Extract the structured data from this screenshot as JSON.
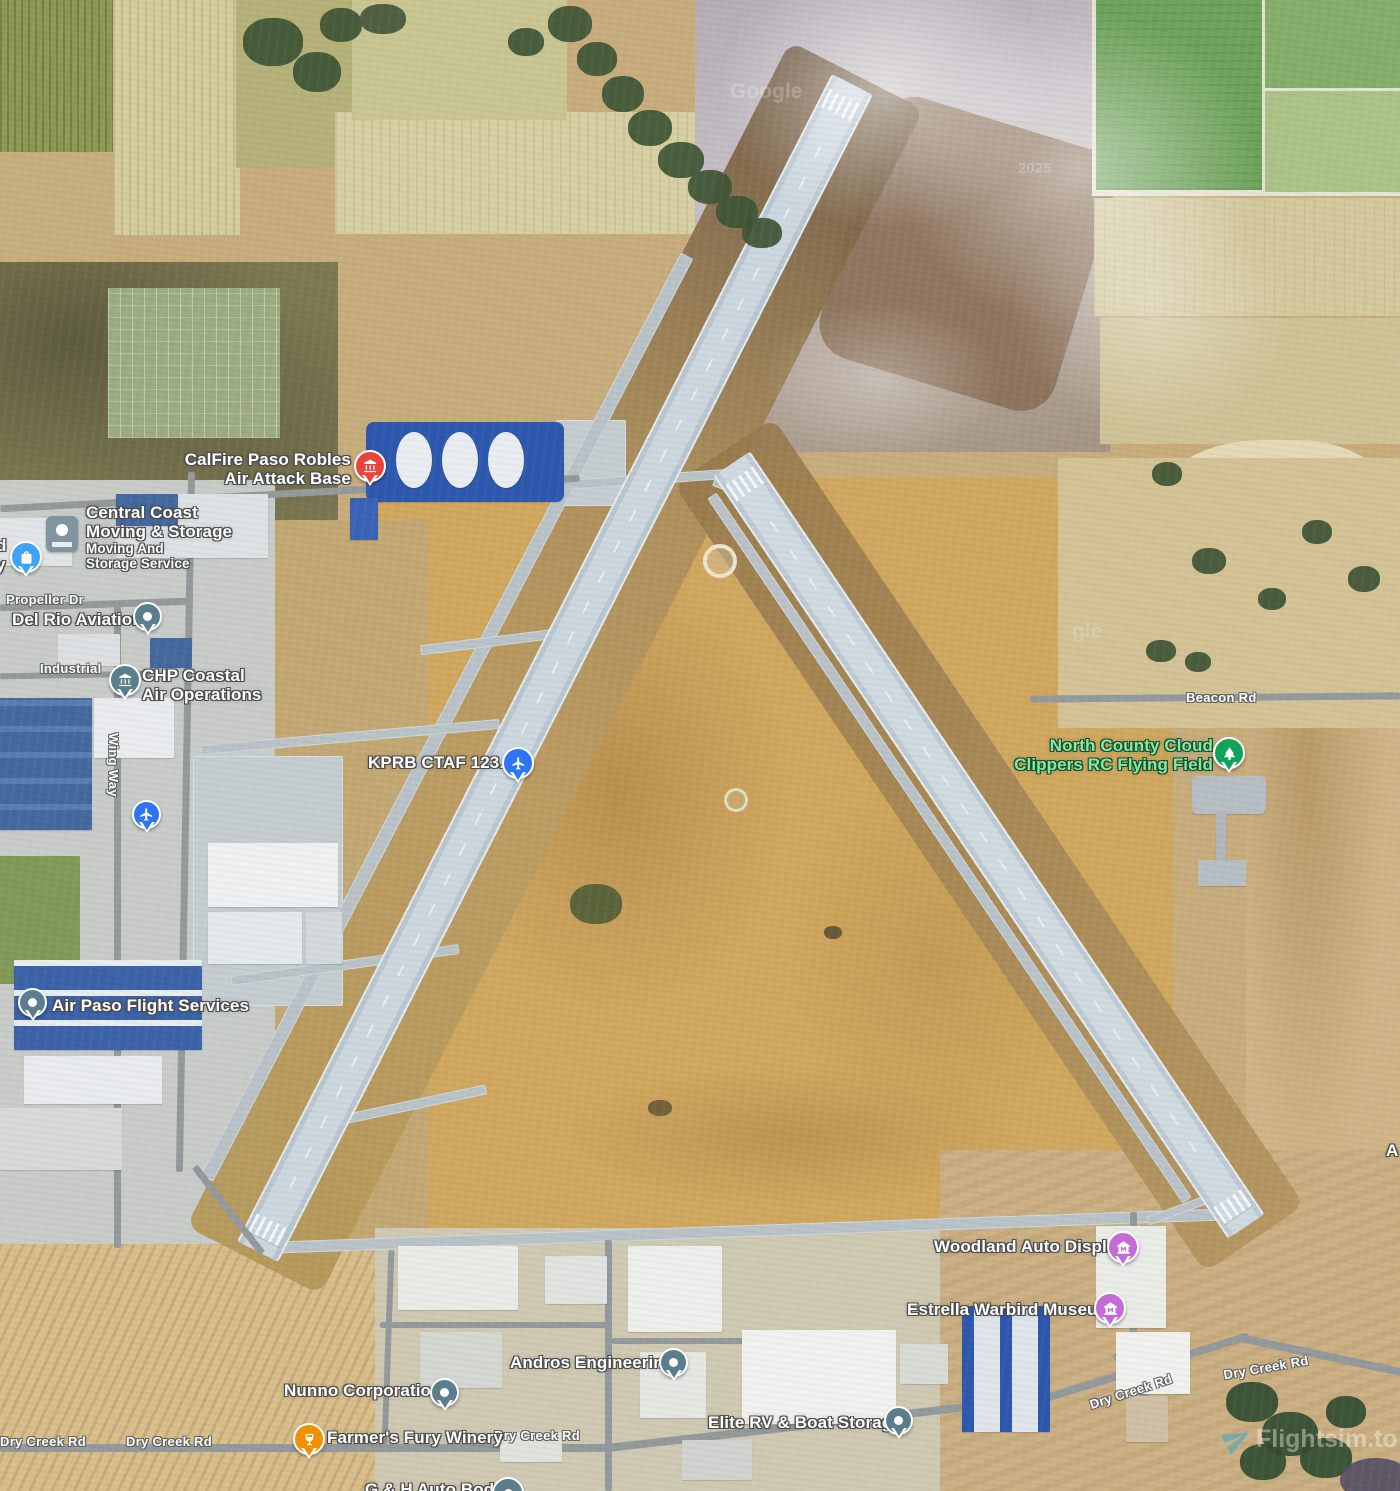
{
  "map": {
    "kind": "satellite",
    "pois": {
      "calfire": {
        "line1": "CalFire Paso Robles",
        "line2": "Air Attack Base",
        "icon": "government-building-icon",
        "pin_color": "#e8443a"
      },
      "central_coast": {
        "line1": "Central Coast",
        "line2": "Moving & Storage",
        "sub1": "Moving And",
        "sub2": "Storage Service",
        "icon": "shopping-bag-icon",
        "pin_color": "#3fa2f7"
      },
      "del_rio": {
        "line1": "Del Rio Aviation",
        "icon": "dot-icon",
        "pin_color": "#5b7e8c"
      },
      "chp": {
        "line1": "CHP Coastal",
        "line2": "Air Operations",
        "icon": "government-building-icon",
        "pin_color": "#5b7e8c"
      },
      "kprb": {
        "line1": "KPRB CTAF 123.0",
        "icon": "airplane-icon",
        "pin_color": "#2e75f3"
      },
      "runway_plane": {
        "icon": "airplane-icon",
        "pin_color": "#2e75f3"
      },
      "north_county": {
        "line1": "North County Cloud",
        "line2": "Clippers RC Flying Field",
        "icon": "tree-icon",
        "pin_color": "#12a35a",
        "text_color": "#8ae5a5"
      },
      "air_paso": {
        "line1": "Air Paso Flight Services",
        "icon": "dot-icon",
        "pin_color": "#5b7e8c"
      },
      "woodland": {
        "line1": "Woodland Auto Display",
        "icon": "museum-icon",
        "pin_color": "#c36bd6"
      },
      "estrella": {
        "line1": "Estrella Warbird Museum",
        "icon": "museum-icon",
        "pin_color": "#c36bd6"
      },
      "andros": {
        "line1": "Andros Engineering",
        "icon": "dot-icon",
        "pin_color": "#5b7e8c"
      },
      "nunno": {
        "line1": "Nunno Corporation",
        "icon": "dot-icon",
        "pin_color": "#5b7e8c"
      },
      "elite": {
        "line1": "Elite RV & Boat Storage",
        "icon": "dot-icon",
        "pin_color": "#5b7e8c"
      },
      "farmers_fury": {
        "line1": "Farmer's Fury Winery",
        "icon": "wine-glass-icon",
        "pin_color": "#f29100"
      },
      "gh_auto": {
        "line1": "G & H Auto Body",
        "icon": "dot-icon",
        "pin_color": "#5b7e8c"
      }
    },
    "roads": {
      "propeller": "Propeller Dr",
      "industrial": "Industrial",
      "wing_way": "Wing Way",
      "beacon": "Beacon Rd",
      "dry_creek": "Dry Creek Rd"
    },
    "edge_partials": {
      "left_1": "d",
      "left_2": "y",
      "right_1": "A"
    },
    "watermarks": {
      "google": "Google",
      "google_partial": "gle",
      "year": "2025",
      "brand": "Flightsim.to"
    }
  }
}
